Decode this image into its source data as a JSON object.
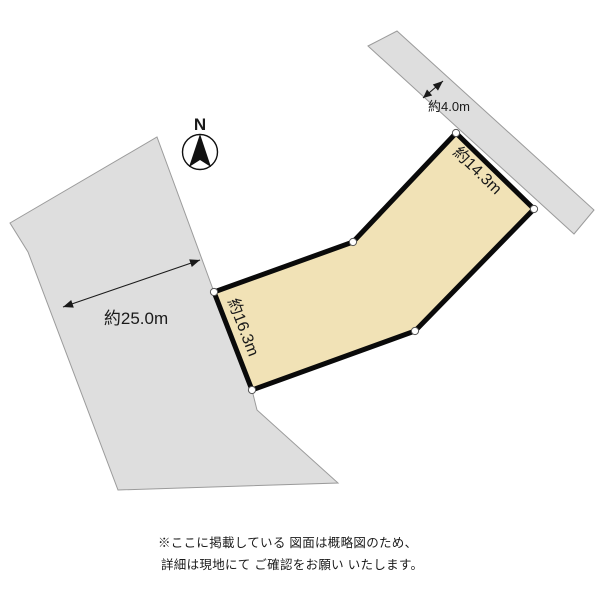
{
  "diagram": {
    "compass_label": "N",
    "labels": {
      "road_width": "約4.0m",
      "frontage_northeast": "約14.3m",
      "side_west": "約16.3m",
      "neighbor_width": "約25.0m"
    },
    "disclaimer_line1": "※ここに掲載している 図面は概略図のため、",
    "disclaimer_line2": "詳細は現地にて ご確認をお願い いたします。",
    "colors": {
      "plot_fill": "#f1e2b6",
      "plot_border": "#0a0a0a",
      "road_fill": "#dedede",
      "neighbor_fill": "#dedede",
      "gray_outline": "#9b9b9b",
      "text": "#1a1a1a"
    },
    "geometry": {
      "road_points": "368,46 397,31 594,210 574,234",
      "neighbor_points": "157,137 214,292 252,390 257,410 338,483 118,490 28,252 10,223",
      "plot_points": "456,133 534,209 415,331 252,390 214,292 353,242",
      "vertices": [
        {
          "x": 456,
          "y": 133
        },
        {
          "x": 534,
          "y": 209
        },
        {
          "x": 415,
          "y": 331
        },
        {
          "x": 252,
          "y": 390
        },
        {
          "x": 214,
          "y": 292
        },
        {
          "x": 353,
          "y": 242
        }
      ]
    }
  }
}
